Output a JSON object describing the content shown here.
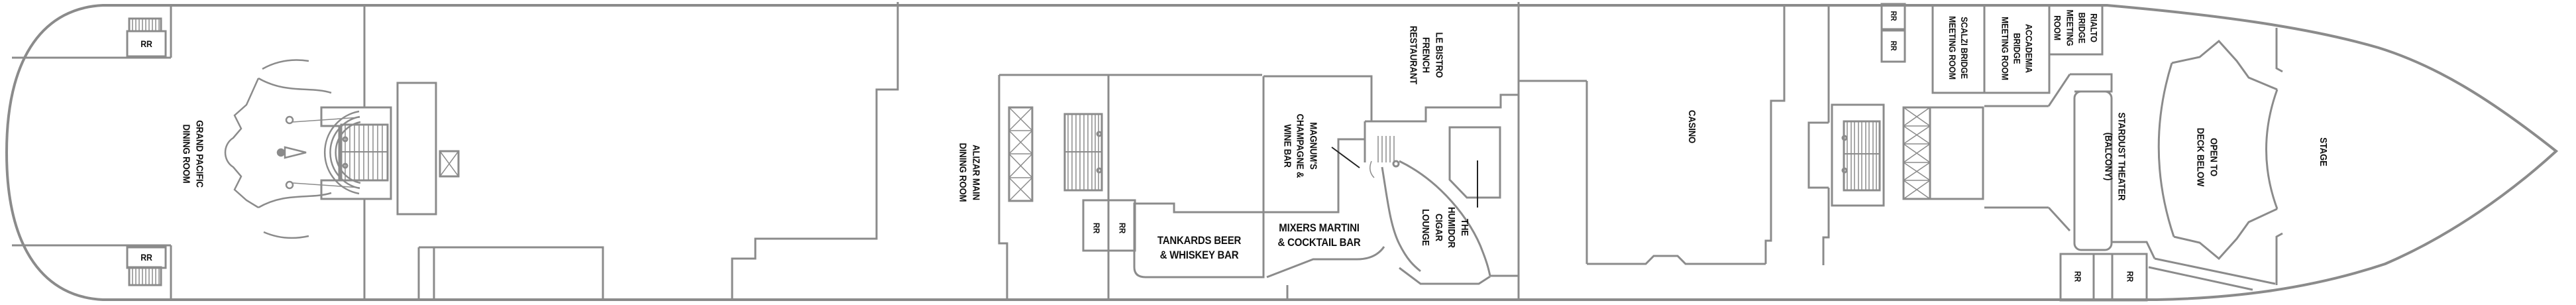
{
  "colors": {
    "wall": "#8b8b8b",
    "text": "#111111",
    "background": "#ffffff",
    "pointer_line": "#222222"
  },
  "restrooms": {
    "label": "RR"
  },
  "rooms": {
    "grand_pacific": {
      "name": "Grand Pacific Dining Room",
      "lines": [
        "GRAND PACIFIC",
        "DINING ROOM"
      ]
    },
    "alizar": {
      "name": "Alizar Main Dining Room",
      "lines": [
        "ALIZAR MAIN",
        "DINING ROOM"
      ]
    },
    "tankards": {
      "name": "Tankards Beer & Whiskey Bar",
      "lines": [
        "TANKARDS BEER",
        "& WHISKEY BAR"
      ]
    },
    "mixers": {
      "name": "Mixers Martini & Cocktail Bar",
      "lines": [
        "MIXERS MARTINI",
        "& COCKTAIL BAR"
      ]
    },
    "magnums": {
      "name": "Magnum's Champagne & Wine Bar",
      "lines": [
        "MAGNUM'S",
        "CHAMPAGNE &",
        "WINE BAR"
      ]
    },
    "le_bistro": {
      "name": "Le Bistro French Restaurant",
      "lines": [
        "LE BISTRO",
        "FRENCH",
        "RESTAURANT"
      ]
    },
    "humidor": {
      "name": "The Humidor Cigar Lounge",
      "lines": [
        "THE",
        "HUMIDOR",
        "CIGAR",
        "LOUNGE"
      ]
    },
    "casino": {
      "name": "Casino",
      "lines": [
        "CASINO"
      ]
    },
    "scalzi": {
      "name": "Scalzi Bridge Meeting Room",
      "lines": [
        "SCALZI BRIDGE",
        "MEETING ROOM"
      ]
    },
    "accademia": {
      "name": "Accademia Bridge Meeting Room",
      "lines": [
        "ACCADEMIA",
        "BRIDGE",
        "MEETING ROOM"
      ]
    },
    "rialto": {
      "name": "Rialto Bridge Meeting Room",
      "lines": [
        "RIALTO",
        "BRIDGE",
        "MEETING",
        "ROOM"
      ]
    },
    "stardust": {
      "name": "Stardust Theater (Balcony)",
      "lines": [
        "STARDUST THEATER",
        "(BALCONY)"
      ]
    },
    "open_below": {
      "name": "Open To Deck Below",
      "lines": [
        "OPEN TO",
        "DECK BELOW"
      ]
    },
    "stage": {
      "name": "Stage",
      "lines": [
        "STAGE"
      ]
    }
  },
  "icons": {
    "stairs": "stairs-icon",
    "elevator": "elevator-crossbox-icon"
  }
}
